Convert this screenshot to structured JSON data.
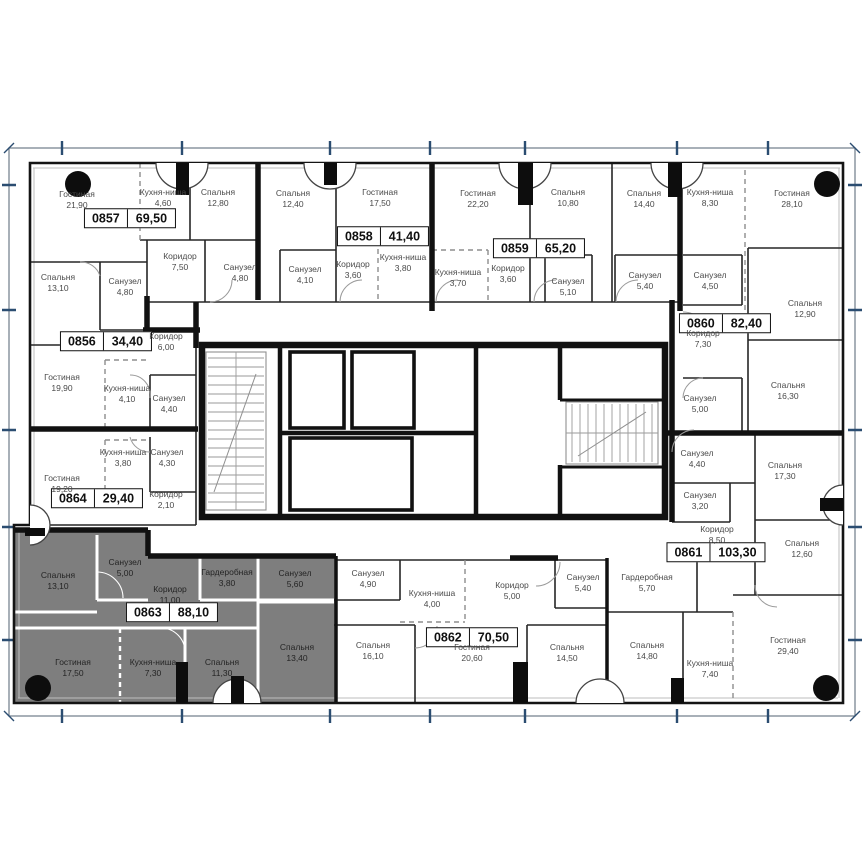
{
  "plan": {
    "type": "residential-floor-plan",
    "highlighted_unit": "0863",
    "language": "ru"
  },
  "colors": {
    "highlight_unit_fill": "#7e7e7e",
    "wall": "#141414",
    "frame_tick": "#2b4d71",
    "room_label_text": "#4a4a4a",
    "unit_box_border": "#101010"
  },
  "units": [
    {
      "id": "0857",
      "area": "69,50",
      "highlighted": false,
      "rooms": [
        {
          "name": "Гостиная",
          "area": "21,90"
        },
        {
          "name": "Кухня-ниша",
          "area": "4,60"
        },
        {
          "name": "Спальня",
          "area": "12,80"
        },
        {
          "name": "Коридор",
          "area": "7,50"
        },
        {
          "name": "Санузел",
          "area": "4,80"
        },
        {
          "name": "Спальня",
          "area": "13,10"
        },
        {
          "name": "Санузел",
          "area": "4,80"
        }
      ]
    },
    {
      "id": "0858",
      "area": "41,40",
      "highlighted": false,
      "rooms": [
        {
          "name": "Спальня",
          "area": "12,40"
        },
        {
          "name": "Гостиная",
          "area": "17,50"
        },
        {
          "name": "Кухня-ниша",
          "area": "3,80"
        },
        {
          "name": "Коридор",
          "area": "3,60"
        },
        {
          "name": "Санузел",
          "area": "4,10"
        }
      ]
    },
    {
      "id": "0859",
      "area": "65,20",
      "highlighted": false,
      "rooms": [
        {
          "name": "Гостиная",
          "area": "22,20"
        },
        {
          "name": "Спальня",
          "area": "10,80"
        },
        {
          "name": "Спальня",
          "area": "14,40"
        },
        {
          "name": "Кухня-ниша",
          "area": "3,70"
        },
        {
          "name": "Коридор",
          "area": "3,60"
        },
        {
          "name": "Санузел",
          "area": "5,10"
        },
        {
          "name": "Санузел",
          "area": "5,40"
        }
      ]
    },
    {
      "id": "0860",
      "area": "82,40",
      "highlighted": false,
      "rooms": [
        {
          "name": "Кухня-ниша",
          "area": "8,30"
        },
        {
          "name": "Гостиная",
          "area": "28,10"
        },
        {
          "name": "Санузел",
          "area": "4,50"
        },
        {
          "name": "Коридор",
          "area": "7,30"
        },
        {
          "name": "Спальня",
          "area": "12,90"
        },
        {
          "name": "Санузел",
          "area": "5,00"
        },
        {
          "name": "Спальня",
          "area": "16,30"
        }
      ]
    },
    {
      "id": "0861",
      "area": "103,30",
      "highlighted": false,
      "rooms": [
        {
          "name": "Санузел",
          "area": "4,40"
        },
        {
          "name": "Спальня",
          "area": "17,30"
        },
        {
          "name": "Санузел",
          "area": "3,20"
        },
        {
          "name": "Коридор",
          "area": "8,50"
        },
        {
          "name": "Спальня",
          "area": "12,60"
        },
        {
          "name": "Гардеробная",
          "area": "5,70"
        },
        {
          "name": "Спальня",
          "area": "14,80"
        },
        {
          "name": "Кухня-ниша",
          "area": "7,40"
        },
        {
          "name": "Гостиная",
          "area": "29,40"
        }
      ]
    },
    {
      "id": "0862",
      "area": "70,50",
      "highlighted": false,
      "rooms": [
        {
          "name": "Санузел",
          "area": "4,90"
        },
        {
          "name": "Кухня-ниша",
          "area": "4,00"
        },
        {
          "name": "Коридор",
          "area": "5,00"
        },
        {
          "name": "Санузел",
          "area": "5,40"
        },
        {
          "name": "Спальня",
          "area": "16,10"
        },
        {
          "name": "Гостиная",
          "area": "20,60"
        },
        {
          "name": "Спальня",
          "area": "14,50"
        }
      ]
    },
    {
      "id": "0863",
      "area": "88,10",
      "highlighted": true,
      "rooms": [
        {
          "name": "Спальня",
          "area": "13,10"
        },
        {
          "name": "Санузел",
          "area": "5,00"
        },
        {
          "name": "Коридор",
          "area": "11,00"
        },
        {
          "name": "Гардеробная",
          "area": "3,80"
        },
        {
          "name": "Санузел",
          "area": "5,60"
        },
        {
          "name": "Гостиная",
          "area": "17,50"
        },
        {
          "name": "Кухня-ниша",
          "area": "7,30"
        },
        {
          "name": "Спальня",
          "area": "11,30"
        },
        {
          "name": "Спальня",
          "area": "13,40"
        }
      ]
    },
    {
      "id": "0864",
      "area": "29,40",
      "highlighted": false,
      "rooms": [
        {
          "name": "Кухня-ниша",
          "area": "3,80"
        },
        {
          "name": "Санузел",
          "area": "4,30"
        },
        {
          "name": "Гостиная",
          "area": "19,20"
        },
        {
          "name": "Коридор",
          "area": "2,10"
        }
      ]
    },
    {
      "id": "0856",
      "area": "34,40",
      "highlighted": false,
      "rooms": [
        {
          "name": "Коридор",
          "area": "6,00"
        },
        {
          "name": "Гостиная",
          "area": "19,90"
        },
        {
          "name": "Кухня-ниша",
          "area": "4,10"
        },
        {
          "name": "Санузел",
          "area": "4,40"
        }
      ]
    }
  ]
}
